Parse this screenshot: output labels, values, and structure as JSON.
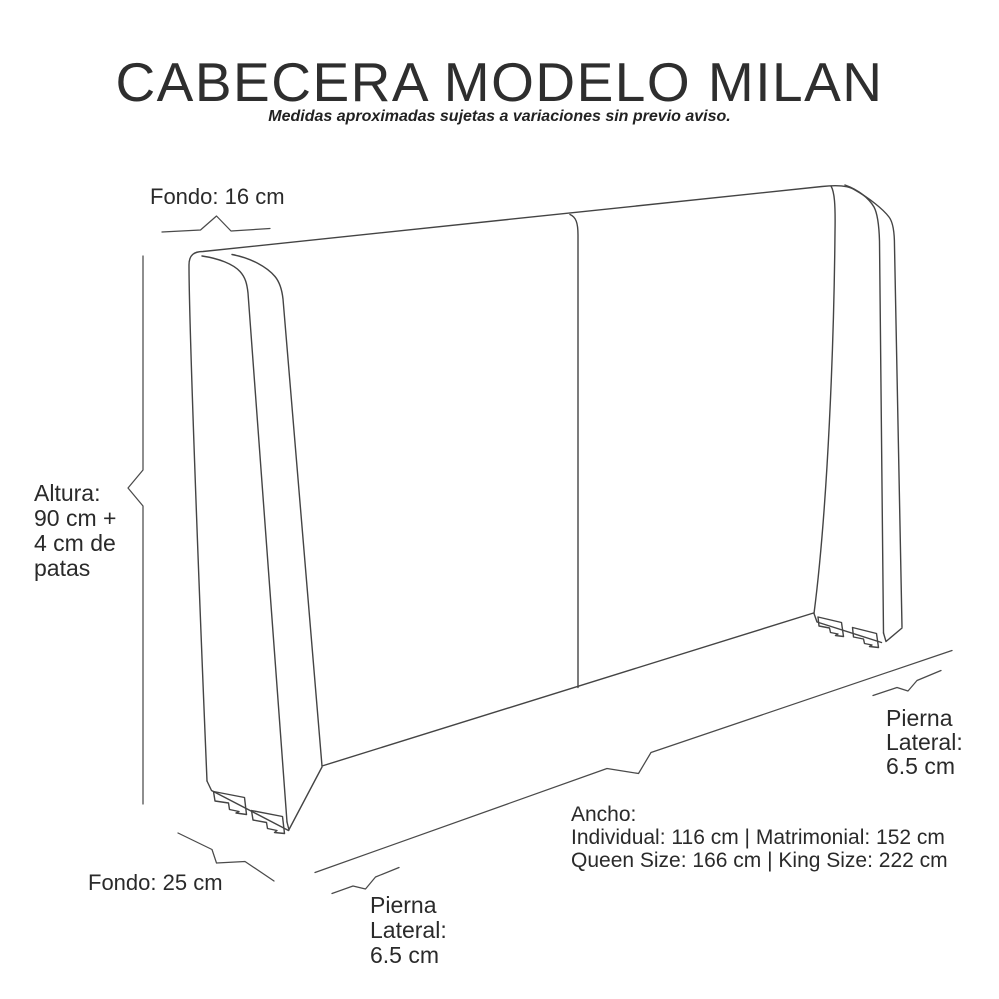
{
  "header": {
    "title": "CABECERA MODELO MILAN",
    "subtitle": "Medidas aproximadas sujetas a variaciones sin previo aviso."
  },
  "dimensions": {
    "fondo_top": {
      "label": "Fondo: 16 cm"
    },
    "altura": {
      "lines": [
        "Altura:",
        "90 cm +",
        "4 cm de",
        "patas"
      ]
    },
    "fondo_bottom": {
      "label": "Fondo: 25 cm"
    },
    "pierna_lateral_bottom": {
      "lines": [
        "Pierna",
        "Lateral:",
        "6.5 cm"
      ]
    },
    "pierna_lateral_right": {
      "lines": [
        "Pierna",
        "Lateral:",
        "6.5 cm"
      ]
    },
    "ancho": {
      "lines": [
        "Ancho:",
        "Individual: 116 cm | Matrimonial: 152 cm",
        "Queen Size: 166 cm | King Size: 222 cm"
      ]
    }
  },
  "colors": {
    "background": "#ffffff",
    "line": "#444444",
    "text": "#2a2a2a"
  }
}
